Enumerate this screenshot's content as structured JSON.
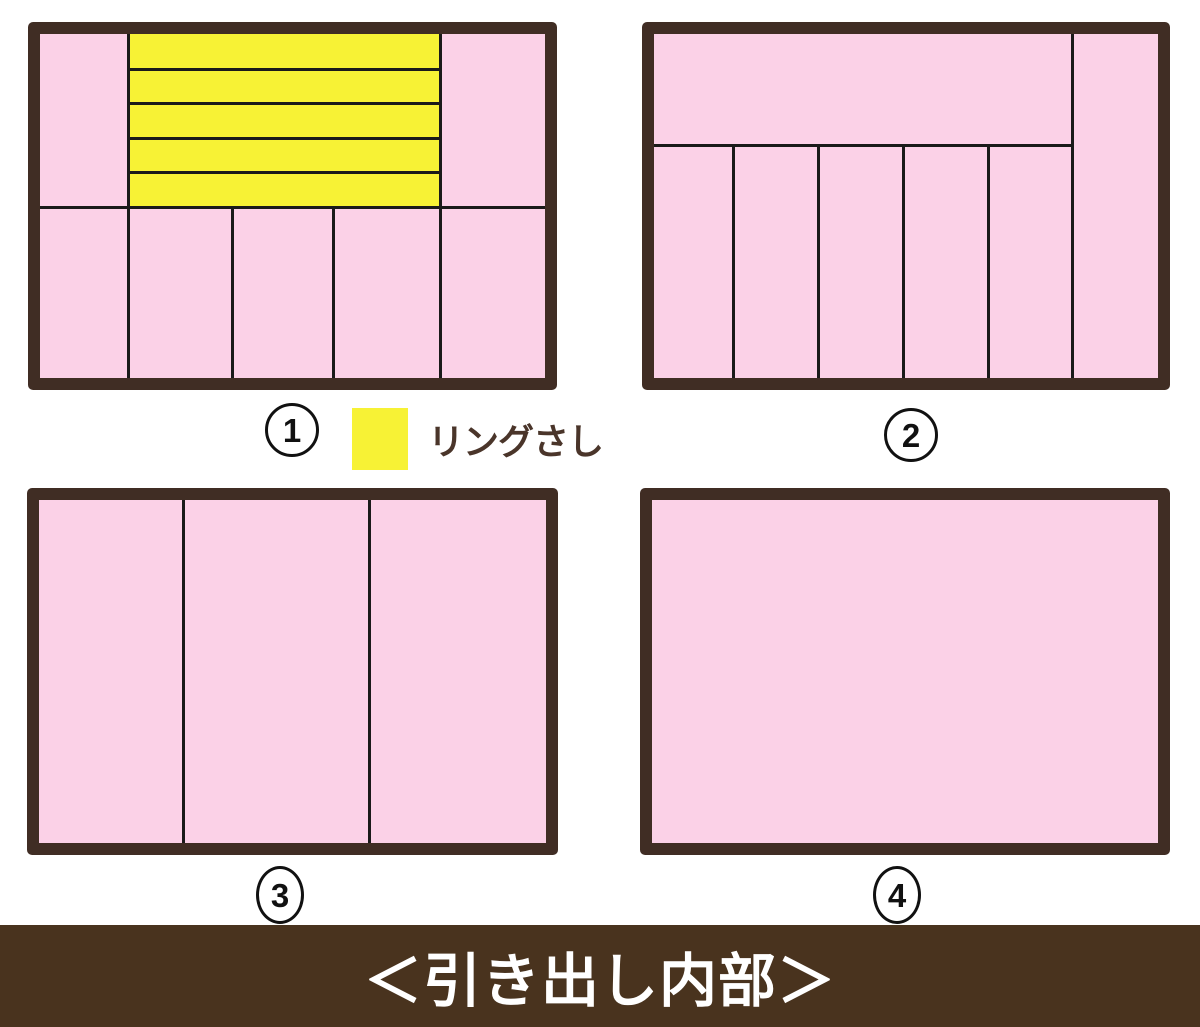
{
  "banner": {
    "text": "＜引き出し内部＞",
    "bg": "#49331e",
    "text_color": "#ffffff"
  },
  "legend": {
    "label": "リングさし",
    "swatch_color": "#f7f235",
    "label_color": "#4a352a"
  },
  "colors": {
    "pink": "#fbd1e7",
    "yellow": "#f7f235",
    "frame_brown": "#402d24",
    "divider_black": "#1a1a1a",
    "background_white": "#ffffff"
  },
  "drawers": [
    {
      "id": 1,
      "number": "1",
      "description": "top: side trays with 5 ring-holder strips in center; bottom: 5 columns",
      "frame": {
        "x": 28,
        "y": 22,
        "w": 529,
        "h": 368,
        "t": 12
      },
      "fills": [
        {
          "name": "ring-holder-area",
          "color_key": "yellow",
          "x": 88,
          "y": 0,
          "w": 312,
          "h": 173
        }
      ],
      "lines": [
        {
          "o": "v",
          "pos": 88,
          "a": 0,
          "b": 344
        },
        {
          "o": "v",
          "pos": 400,
          "a": 0,
          "b": 344
        },
        {
          "o": "h",
          "pos": 173,
          "a": 0,
          "b": 505
        },
        {
          "o": "h",
          "pos": 35,
          "a": 88,
          "b": 400
        },
        {
          "o": "h",
          "pos": 69,
          "a": 88,
          "b": 400
        },
        {
          "o": "h",
          "pos": 104,
          "a": 88,
          "b": 400
        },
        {
          "o": "h",
          "pos": 138,
          "a": 88,
          "b": 400
        },
        {
          "o": "v",
          "pos": 192,
          "a": 173,
          "b": 344
        },
        {
          "o": "v",
          "pos": 293,
          "a": 173,
          "b": 344
        }
      ]
    },
    {
      "id": 2,
      "number": "2",
      "description": "full-height right column; wide top tray; 5 bottom columns",
      "frame": {
        "x": 642,
        "y": 22,
        "w": 528,
        "h": 368,
        "t": 12
      },
      "fills": [],
      "lines": [
        {
          "o": "v",
          "pos": 418,
          "a": 0,
          "b": 344
        },
        {
          "o": "h",
          "pos": 111,
          "a": 0,
          "b": 418
        },
        {
          "o": "v",
          "pos": 79,
          "a": 111,
          "b": 344
        },
        {
          "o": "v",
          "pos": 164,
          "a": 111,
          "b": 344
        },
        {
          "o": "v",
          "pos": 249,
          "a": 111,
          "b": 344
        },
        {
          "o": "v",
          "pos": 334,
          "a": 111,
          "b": 344
        }
      ]
    },
    {
      "id": 3,
      "number": "3",
      "description": "3 full-height columns",
      "frame": {
        "x": 27,
        "y": 488,
        "w": 531,
        "h": 367,
        "t": 12
      },
      "fills": [],
      "lines": [
        {
          "o": "v",
          "pos": 144,
          "a": 0,
          "b": 343
        },
        {
          "o": "v",
          "pos": 330,
          "a": 0,
          "b": 343
        }
      ]
    },
    {
      "id": 4,
      "number": "4",
      "description": "single open compartment",
      "frame": {
        "x": 640,
        "y": 488,
        "w": 530,
        "h": 367,
        "t": 12
      },
      "fills": [],
      "lines": []
    }
  ]
}
